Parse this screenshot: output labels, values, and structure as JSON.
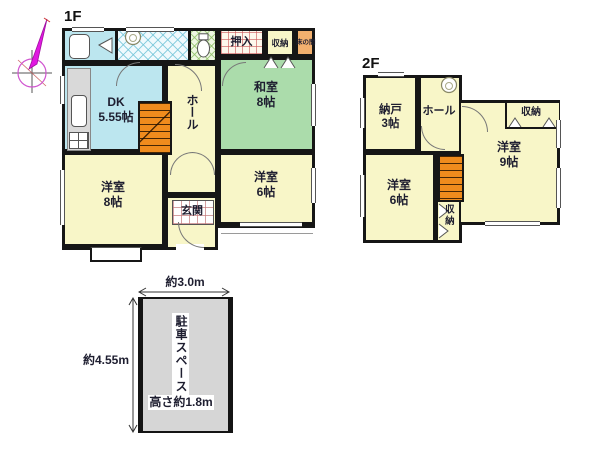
{
  "colors": {
    "room_cream": "#F8F6C8",
    "tatami_green": "#ABDCAB",
    "water_cyan": "#BCE6EF",
    "stairs_orange": "#EF8B1D",
    "tokonoma_orange": "#F2B06E",
    "parking_gray": "#D6D6D6",
    "wall_black": "#161616",
    "compass_magenta": "#E018E0"
  },
  "floor1": {
    "title": "1F",
    "rooms": {
      "washitsu": {
        "name": "和室",
        "size": "8帖"
      },
      "dk": {
        "name": "DK",
        "size": "5.55帖"
      },
      "hall": {
        "name": "ホール"
      },
      "yoshitsu8": {
        "name": "洋室",
        "size": "8帖"
      },
      "yoshitsu6": {
        "name": "洋室",
        "size": "6帖"
      },
      "genkan": {
        "name": "玄関"
      },
      "oshiire": {
        "name": "押入"
      },
      "shunou": {
        "name": "収納"
      },
      "tokonoma": {
        "name": "床の間"
      }
    }
  },
  "floor2": {
    "title": "2F",
    "rooms": {
      "nando": {
        "name": "納戸",
        "size": "3帖"
      },
      "hall": {
        "name": "ホール"
      },
      "yoshitsu9": {
        "name": "洋室",
        "size": "9帖"
      },
      "yoshitsu6": {
        "name": "洋室",
        "size": "6帖"
      },
      "shunou_top": {
        "name": "収納"
      },
      "shunou_bottom": {
        "name": "収納"
      }
    }
  },
  "parking": {
    "label": "駐車スペース",
    "width_label": "約3.0m",
    "depth_label": "約4.55m",
    "height_label": "高さ約1.8m"
  }
}
